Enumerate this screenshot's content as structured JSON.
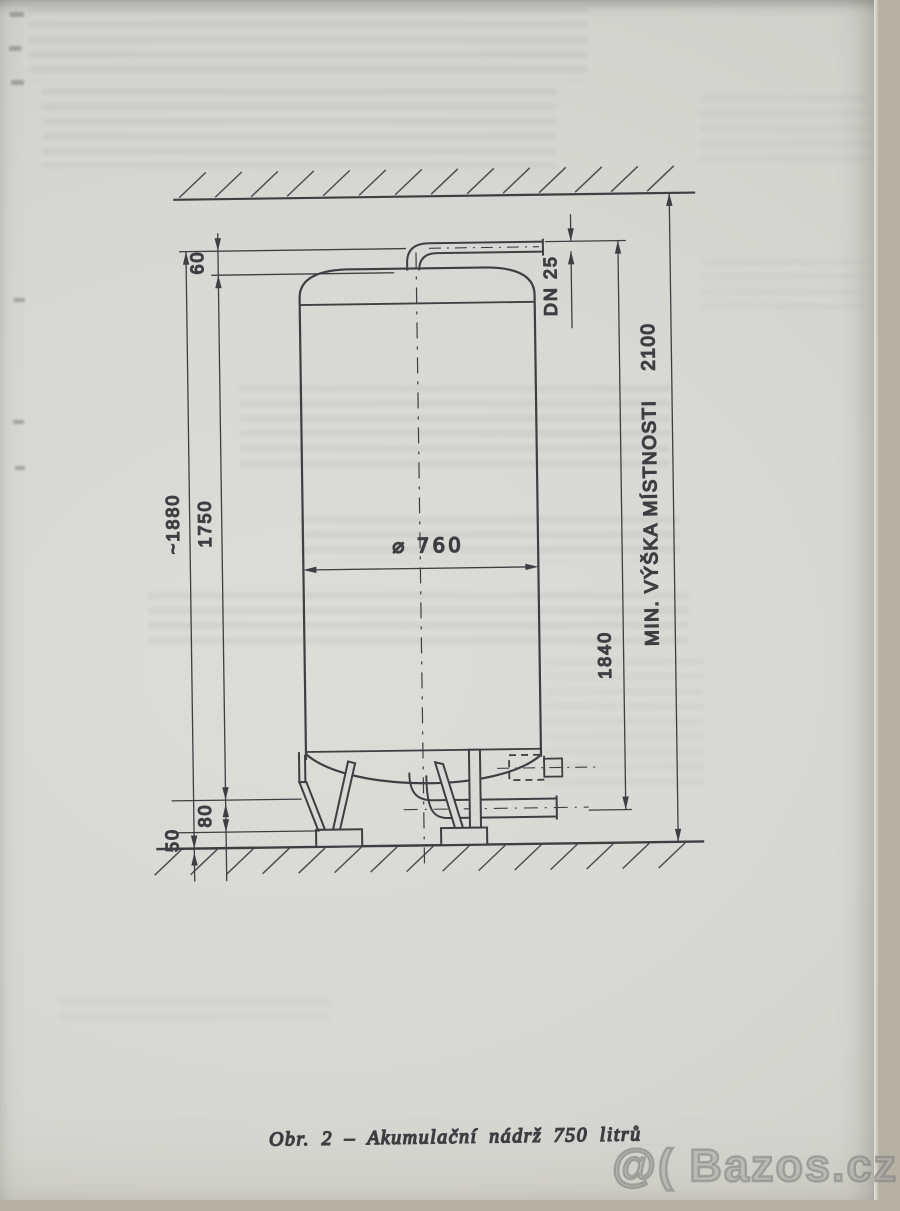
{
  "figure": {
    "caption": "Obr. 2 – Akumulační nádrž 750 litrů"
  },
  "dimensions": {
    "overall_height": "~1880",
    "tank_height": "1750",
    "top_offset": "60",
    "bottom_offset": "80",
    "foot_height": "50",
    "diameter": "⌀ 760",
    "pipe_nominal": "DN 25",
    "pipe_height": "1840",
    "min_room_height_label": "MIN. VÝŠKA MÍSTNOSTI",
    "min_room_height_value": "2100"
  },
  "watermark": "@( Bazos.cz"
}
